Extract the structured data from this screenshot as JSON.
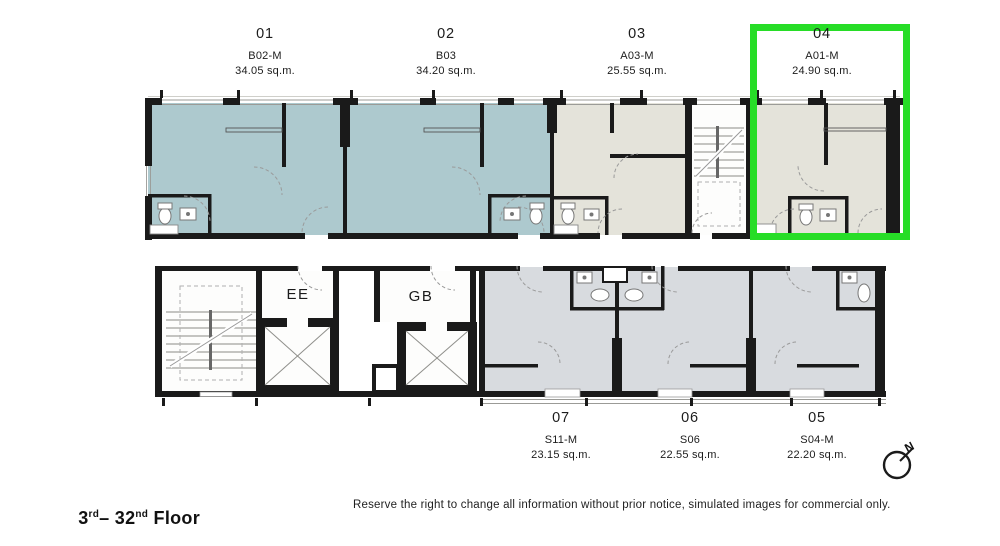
{
  "page": {
    "floor_label": {
      "base": "3",
      "base_suffix": "rd",
      "separator": "– ",
      "top": "32",
      "top_suffix": "nd",
      "suffix": " Floor"
    },
    "disclaimer": "Reserve the right to change all information without prior notice, simulated images for commercial only."
  },
  "plan": {
    "wall_color": "#1a1a1a",
    "highlight": {
      "unit": "04",
      "color": "#27dd27"
    },
    "fills": {
      "b_type": "#adc9ce",
      "a_type": "#e4e3da",
      "s_type": "#d8dbdf",
      "core": "#fdfdfc"
    }
  },
  "units": [
    {
      "number": "01",
      "type": "B02-M",
      "area": "34.05 sq.m.",
      "fill": "#adc9ce",
      "highlighted": false
    },
    {
      "number": "02",
      "type": "B03",
      "area": "34.20 sq.m.",
      "fill": "#adc9ce",
      "highlighted": false
    },
    {
      "number": "03",
      "type": "A03-M",
      "area": "25.55 sq.m.",
      "fill": "#e4e3da",
      "highlighted": false
    },
    {
      "number": "04",
      "type": "A01-M",
      "area": "24.90 sq.m.",
      "fill": "#e4e3da",
      "highlighted": true
    },
    {
      "number": "05",
      "type": "S04-M",
      "area": "22.20 sq.m.",
      "fill": "#d8dbdf",
      "highlighted": false
    },
    {
      "number": "06",
      "type": "S06",
      "area": "22.55 sq.m.",
      "fill": "#d8dbdf",
      "highlighted": false
    },
    {
      "number": "07",
      "type": "S11-M",
      "area": "23.15 sq.m.",
      "fill": "#d8dbdf",
      "highlighted": false
    }
  ],
  "cores": {
    "elevator_a": "EE",
    "elevator_b": "GB"
  },
  "compass": {
    "north_label": "N"
  }
}
